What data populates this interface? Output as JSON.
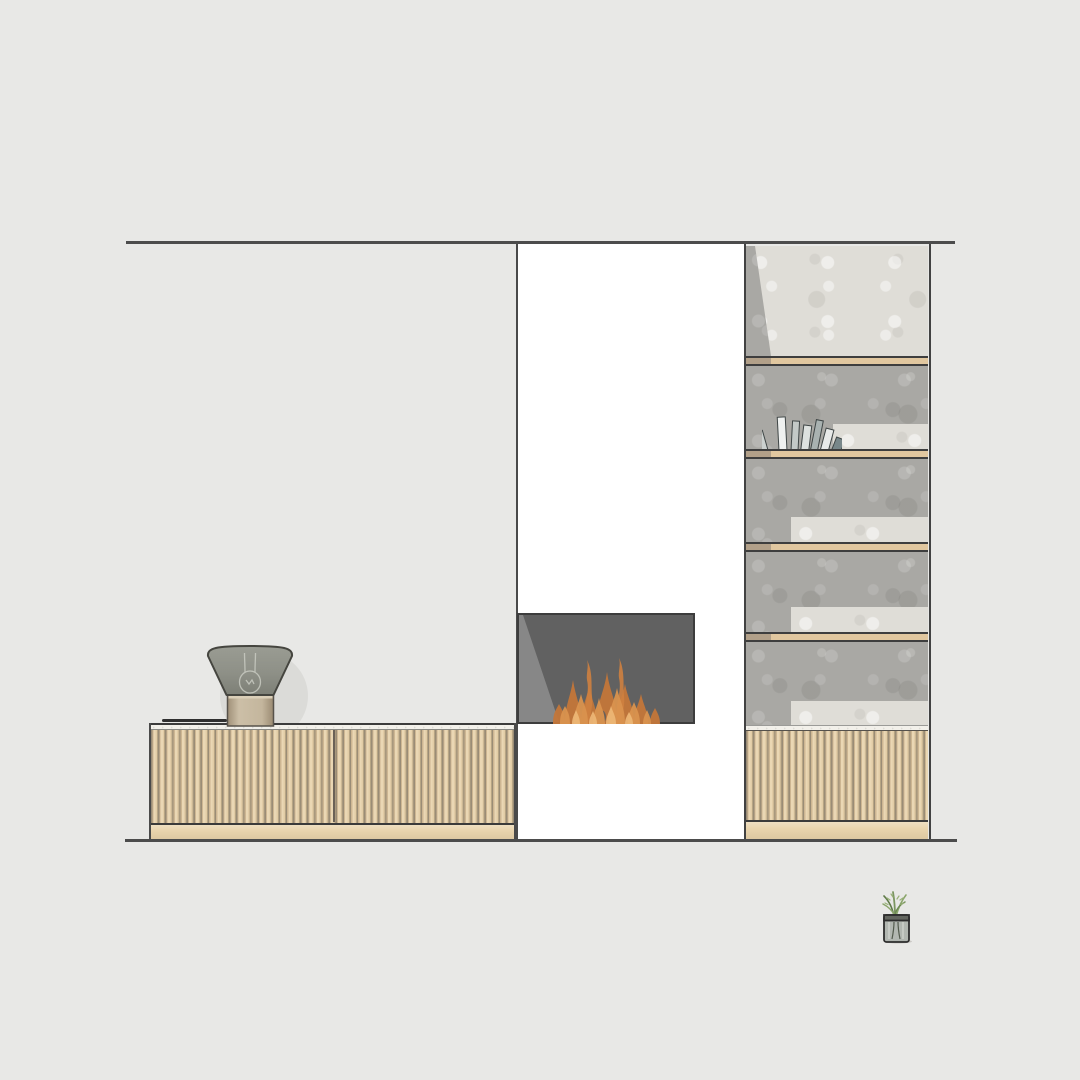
{
  "scene": {
    "type": "interior-elevation-drawing",
    "description": "Living-room wall elevation: slatted wood media cabinet with table lamp and tray, white chimney breast with lit inset fireplace, and tall concrete-backed shelving unit with wood shelves, leaning books, glass vase plant and slatted base cabinet",
    "visible_text": "none"
  },
  "colors": {
    "background": "#e8e8e6",
    "architectural_line": "#4c4c4c",
    "chimney_panel": "#ffffff",
    "fireplace_body": "#616161",
    "fireplace_sheen": "#8e8e8e",
    "flame_back": "#c4773a",
    "flame_mid": "#da934e",
    "flame_front": "#eeb877",
    "flame_wisp": "#cf8140",
    "ember_gap": "#5e5e5e",
    "slat_light": "#ead7b4",
    "slat_mid": "#cdb692",
    "slat_groove": "#9a8c76",
    "plinth_wood": "#e9d4ad",
    "counter_marble": "#f2f0ea",
    "concrete_gray": "#a9a8a4",
    "concrete_light": "#dfddd7",
    "shelf_wood": "#e1c79f",
    "shelf_wood_end": "#b2a089",
    "lamp_shade": "#94968d",
    "lamp_base_wood": "#bfb098",
    "lamp_shadow": "#dbdbd8",
    "tray": "#2f2f2f",
    "plant_green": "#7b9660",
    "vase_glass": "#adb2ad",
    "vase_rim": "#63665f",
    "book_spines": [
      "#ccd1cf",
      "#eff1f0",
      "#c3c9c7",
      "#dde1df",
      "#a9b2b1",
      "#e8eae9",
      "#78878a"
    ]
  },
  "left_cabinet": {
    "name": "media cabinet",
    "finish": "vertical wood slats",
    "door_count": 2,
    "items_on_top": [
      "cone-shade table lamp",
      "black tray"
    ]
  },
  "fireplace": {
    "name": "inset fireplace",
    "state": "lit",
    "flame_count": 7
  },
  "shelving_unit": {
    "name": "shelving unit",
    "shelf_count": 4,
    "compartment_count": 5,
    "base": "slatted cabinet with plinth",
    "decor": [
      "7 leaning books",
      "plant in glass vase"
    ]
  }
}
